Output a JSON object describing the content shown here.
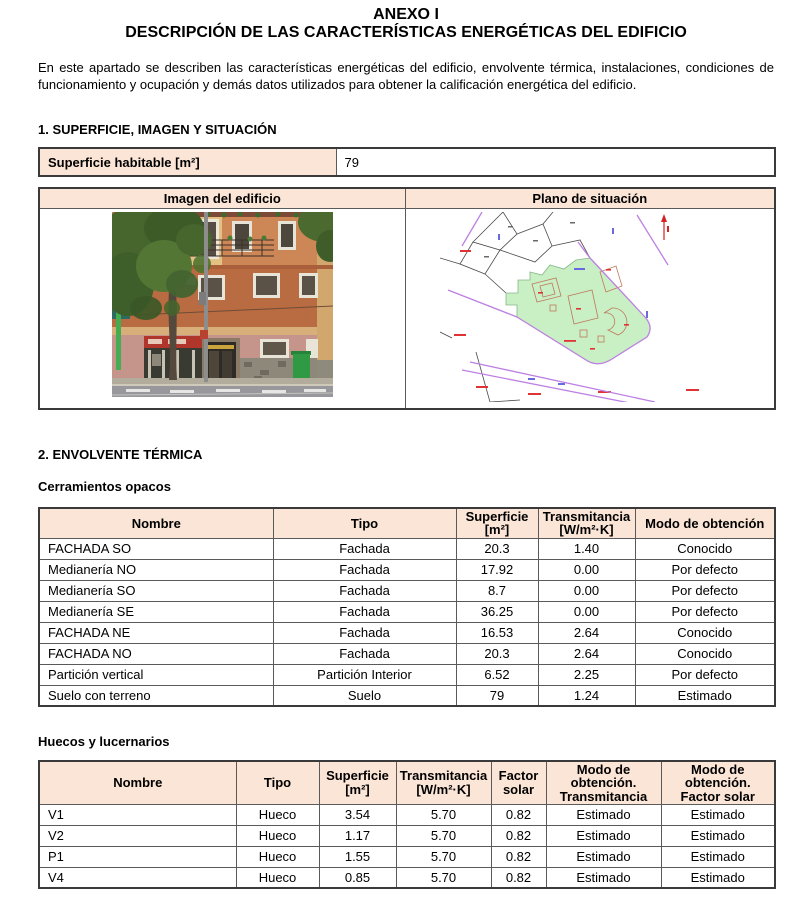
{
  "page": {
    "title_line1": "ANEXO I",
    "title_line2": "DESCRIPCIÓN DE LAS CARACTERÍSTICAS ENERGÉTICAS DEL EDIFICIO",
    "intro": "En este apartado se describen las características energéticas del edificio, envolvente térmica, instalaciones, condiciones de funcionamiento y ocupación y demás datos utilizados para obtener la calificación energética del edificio."
  },
  "section1": {
    "heading": "1. SUPERFICIE, IMAGEN Y SITUACIÓN",
    "superficie_table": {
      "label": "Superficie habitable [m²]",
      "value": "79"
    },
    "media_table": {
      "image_header": "Imagen del edificio",
      "plan_header": "Plano de situación"
    }
  },
  "section2": {
    "heading": "2. ENVOLVENTE TÉRMICA",
    "opacos": {
      "subheading": "Cerramientos opacos",
      "columns": [
        [
          "Nombre"
        ],
        [
          "Tipo"
        ],
        [
          "Superficie",
          "[m²]"
        ],
        [
          "Transmitancia",
          "[W/m²·K]"
        ],
        [
          "Modo de obtención"
        ]
      ],
      "rows": [
        [
          "FACHADA SO",
          "Fachada",
          "20.3",
          "1.40",
          "Conocido"
        ],
        [
          "Medianería NO",
          "Fachada",
          "17.92",
          "0.00",
          "Por defecto"
        ],
        [
          "Medianería SO",
          "Fachada",
          "8.7",
          "0.00",
          "Por defecto"
        ],
        [
          "Medianería SE",
          "Fachada",
          "36.25",
          "0.00",
          "Por defecto"
        ],
        [
          "FACHADA NE",
          "Fachada",
          "16.53",
          "2.64",
          "Conocido"
        ],
        [
          "FACHADA NO",
          "Fachada",
          "20.3",
          "2.64",
          "Conocido"
        ],
        [
          "Partición vertical",
          "Partición Interior",
          "6.52",
          "2.25",
          "Por defecto"
        ],
        [
          "Suelo con terreno",
          "Suelo",
          "79",
          "1.24",
          "Estimado"
        ]
      ]
    },
    "huecos": {
      "subheading": "Huecos y lucernarios",
      "columns": [
        [
          "Nombre"
        ],
        [
          "Tipo"
        ],
        [
          "Superficie",
          "[m²]"
        ],
        [
          "Transmitancia",
          "[W/m²·K]"
        ],
        [
          "Factor",
          "solar"
        ],
        [
          "Modo de",
          "obtención.",
          "Transmitancia"
        ],
        [
          "Modo de",
          "obtención.",
          "Factor solar"
        ]
      ],
      "rows": [
        [
          "V1",
          "Hueco",
          "3.54",
          "5.70",
          "0.82",
          "Estimado",
          "Estimado"
        ],
        [
          "V2",
          "Hueco",
          "1.17",
          "5.70",
          "0.82",
          "Estimado",
          "Estimado"
        ],
        [
          "P1",
          "Hueco",
          "1.55",
          "5.70",
          "0.82",
          "Estimado",
          "Estimado"
        ],
        [
          "V4",
          "Hueco",
          "0.85",
          "5.70",
          "0.82",
          "Estimado",
          "Estimado"
        ]
      ]
    }
  },
  "colors": {
    "header_cell_bg": "#fbe5d6",
    "outer_border": "#3a3a3a",
    "inner_border": "#5a5a5a"
  }
}
